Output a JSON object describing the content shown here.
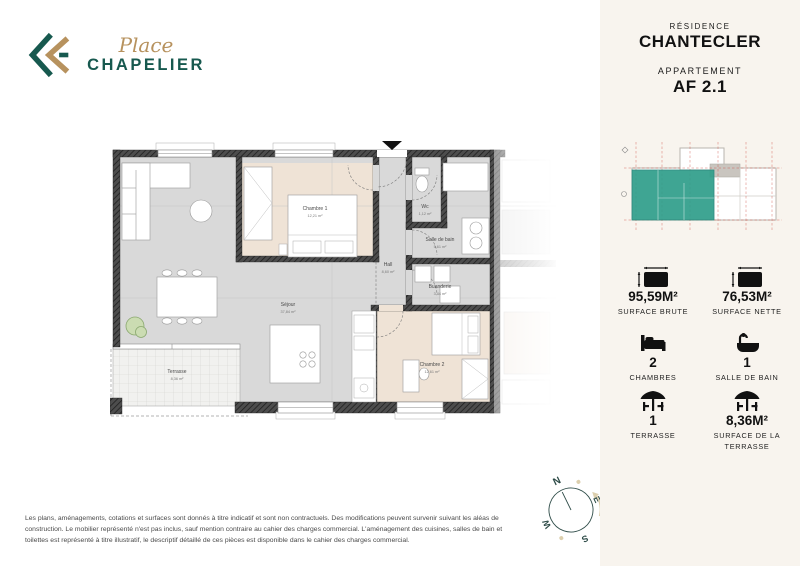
{
  "brand": {
    "name_script": "Place",
    "name_caps": "CHAPELIER",
    "teal": "#17594f",
    "gold": "#b7925e"
  },
  "sidebar": {
    "residence_label": "RÉSIDENCE",
    "residence_name": "CHANTECLER",
    "apartment_label": "APPARTEMENT",
    "apartment_name": "AF 2.1",
    "highlight_color": "#2f9e8a",
    "stats": [
      {
        "icon": "surface-icon",
        "value": "95,59M²",
        "label": "SURFACE BRUTE"
      },
      {
        "icon": "surface-icon",
        "value": "76,53M²",
        "label": "SURFACE NETTE"
      },
      {
        "icon": "bed-icon",
        "value": "2",
        "label": "CHAMBRES"
      },
      {
        "icon": "bath-icon",
        "value": "1",
        "label": "SALLE DE BAIN"
      },
      {
        "icon": "terrace-icon",
        "value": "1",
        "label": "TERRASSE"
      },
      {
        "icon": "terrace-icon",
        "value": "8,36M²",
        "label": "SURFACE DE LA TERRASSE"
      }
    ]
  },
  "plan": {
    "rooms": [
      {
        "name": "Chambre 1",
        "area": "12,21 m²"
      },
      {
        "name": "Wc",
        "area": "1,12 m²"
      },
      {
        "name": "Salle de bain",
        "area": "5,61 m²"
      },
      {
        "name": "Hall",
        "area": "8,60 m²"
      },
      {
        "name": "Buanderie",
        "area": "3,44 m²"
      },
      {
        "name": "Séjour",
        "area": "37,84 m²"
      },
      {
        "name": "Chambre 2",
        "area": "12,61 m²"
      },
      {
        "name": "Terrasse",
        "area": "8,36 m²"
      }
    ]
  },
  "compass": {
    "n": "N",
    "e": "E",
    "s": "S",
    "w": "W"
  },
  "footer": {
    "disclaimer": "Les plans, aménagements, cotations et surfaces sont donnés à titre indicatif et sont non contractuels. Des modifications peuvent survenir suivant les aléas de construction. Le mobilier représenté n'est pas inclus, sauf mention contraire au cahier des charges commercial. L'aménagement des cuisines, salles de bain et toilettes est représenté à titre illustratif, le descriptif détaillé de ces pièces est disponible dans le cahier des charges commercial."
  }
}
